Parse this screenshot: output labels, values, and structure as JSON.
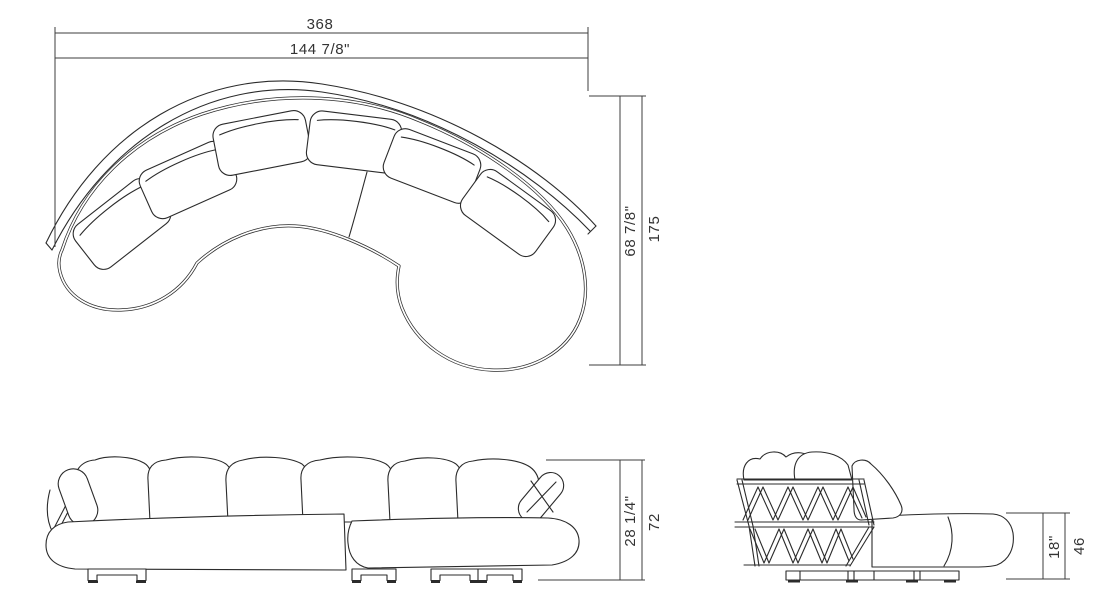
{
  "dimensions": {
    "width": {
      "cm": "368",
      "inches": "144 7/8\""
    },
    "depth": {
      "cm": "175",
      "inches": "68 7/8\""
    },
    "height": {
      "cm": "72",
      "inches": "28 1/4\""
    },
    "seat_height": {
      "cm": "46",
      "inches": "18\""
    }
  }
}
